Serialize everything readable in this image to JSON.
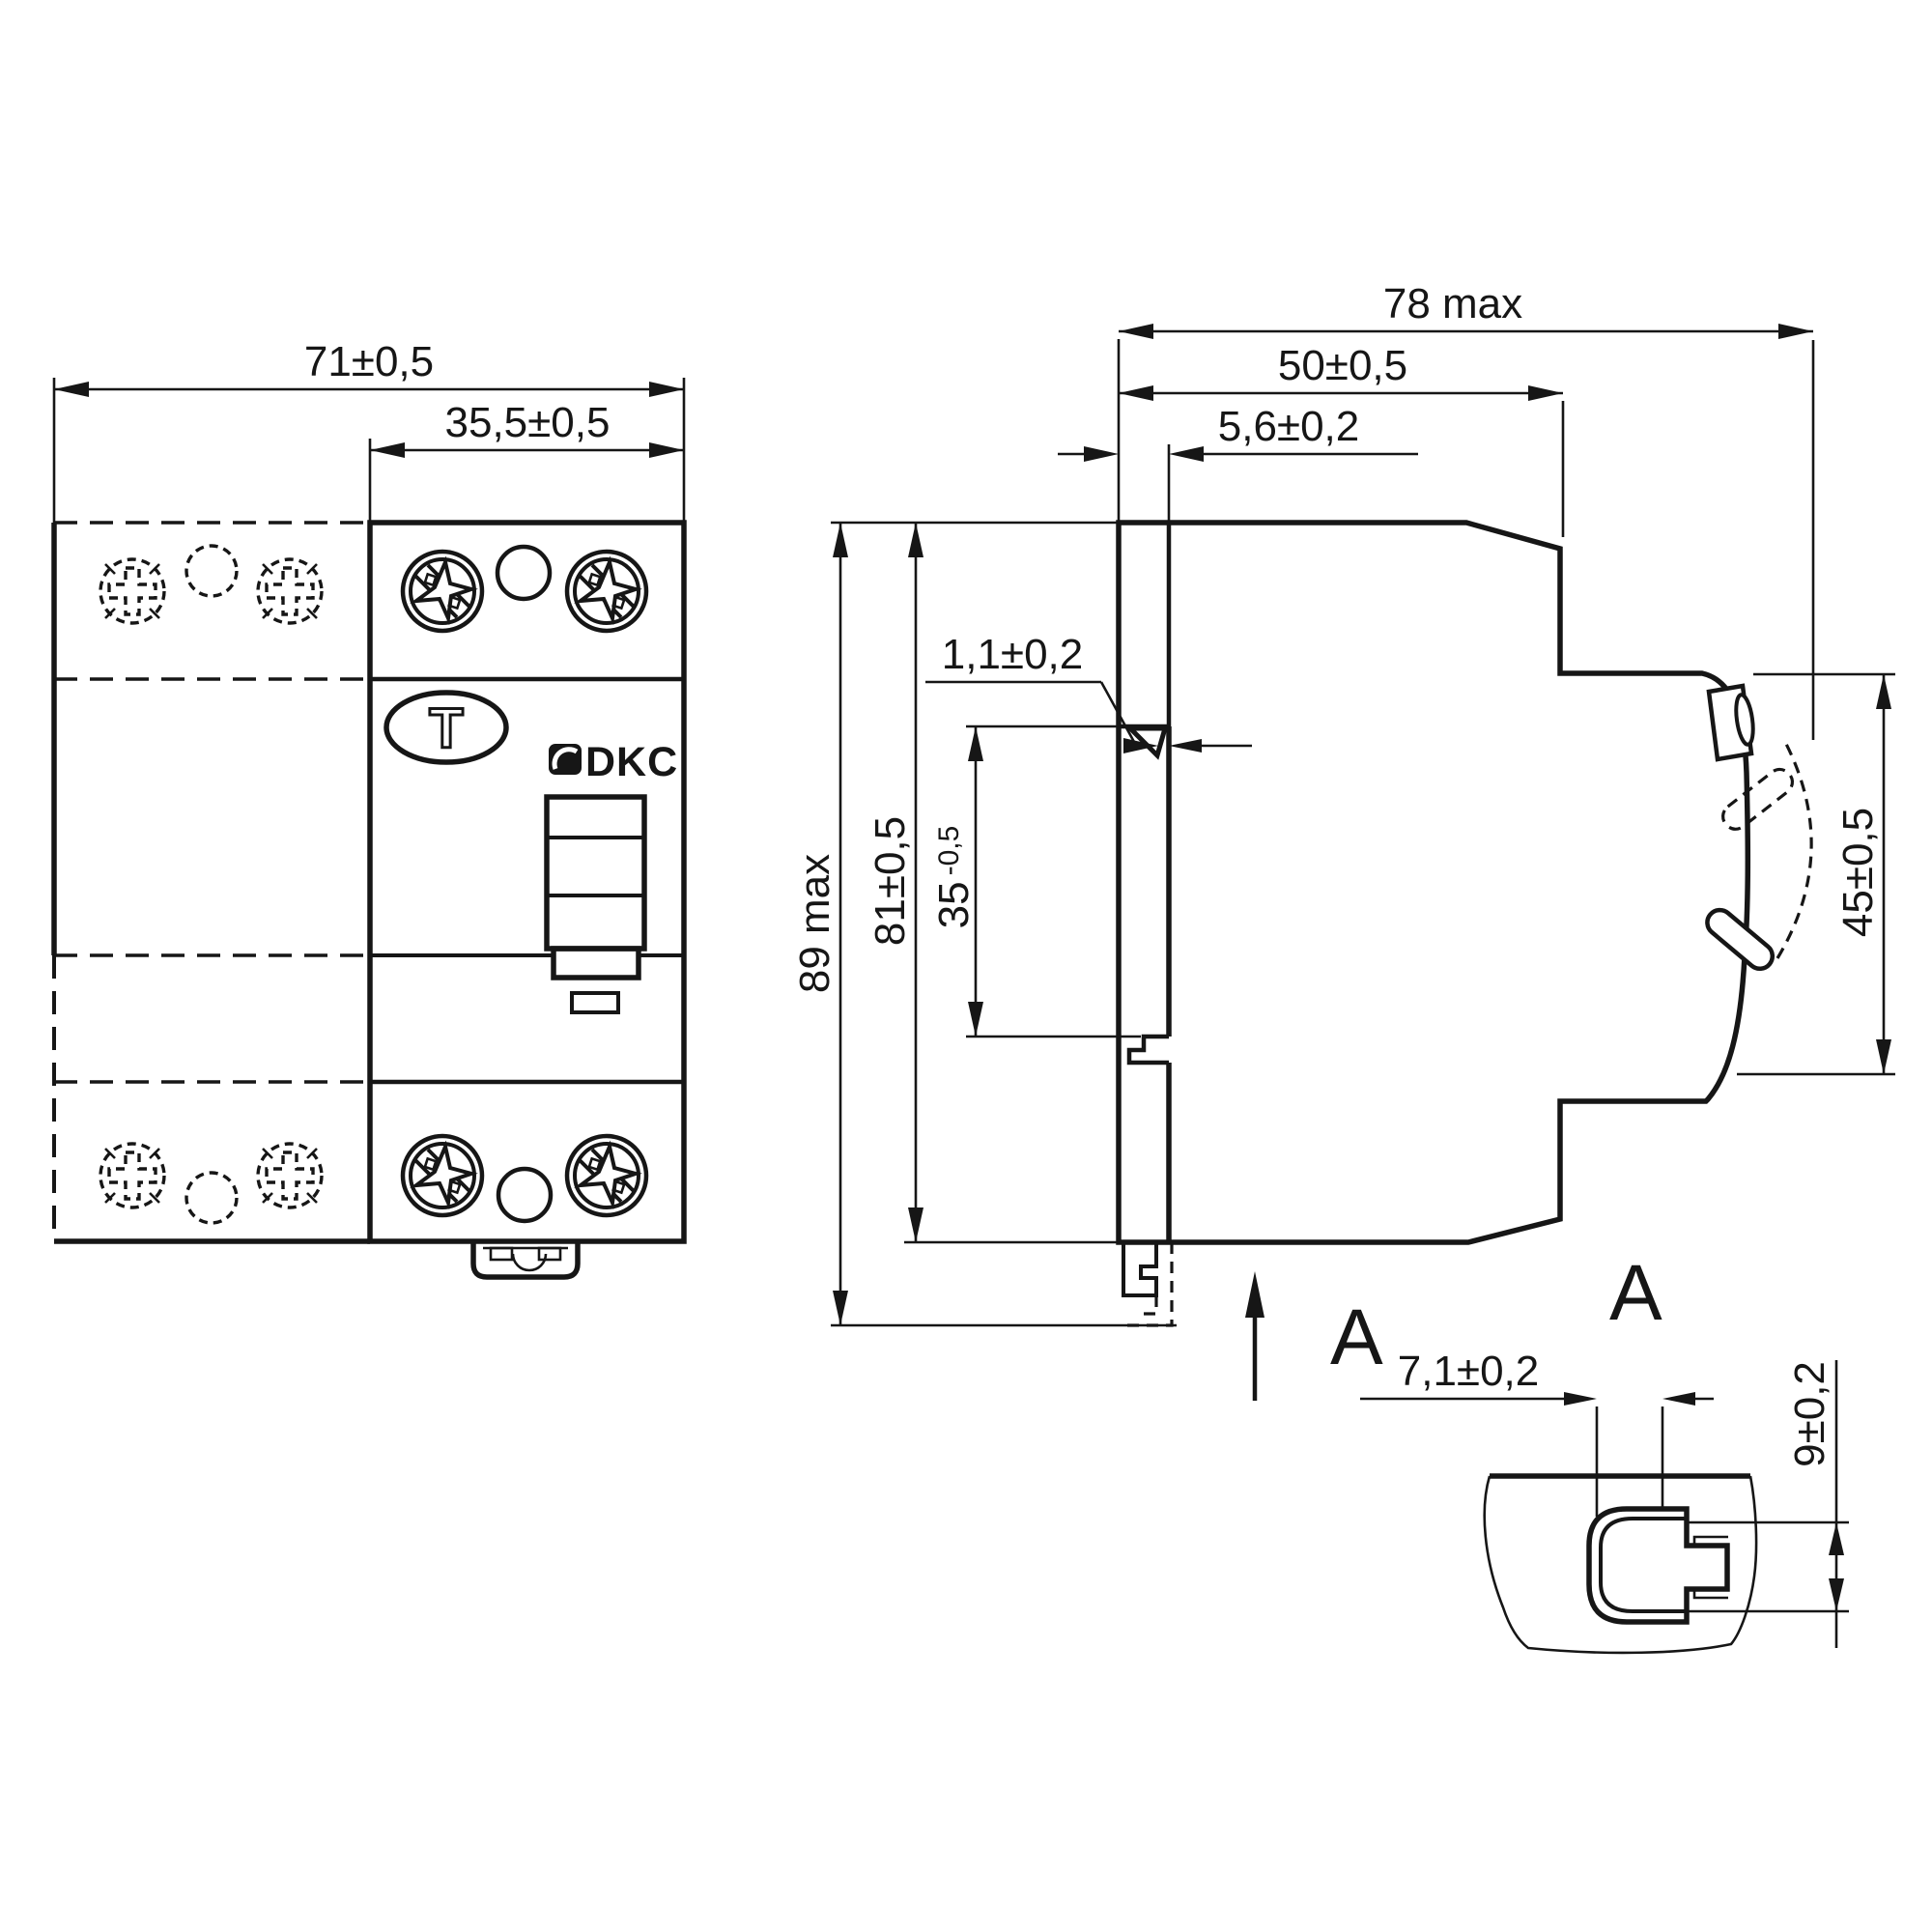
{
  "style": {
    "ink": "#161616",
    "background": "#ffffff"
  },
  "front_view": {
    "dim_width": "71±0,5",
    "dim_module_width": "35,5±0,5",
    "test_button_label": "T",
    "brand": "DKC"
  },
  "side_view": {
    "dim_depth_max": "78 max",
    "dim_depth": "50±0,5",
    "dim_din_offset": "5,6±0,2",
    "dim_notch": "1,1±0,2",
    "dim_height_max": "89 max",
    "dim_height": "81±0,5",
    "dim_rail_width": "35",
    "dim_rail_tolerance": "-0,5",
    "dim_front_height": "45±0,5",
    "view_label": "A"
  },
  "detail_view": {
    "title": "A",
    "dim_width": "7,1±0,2",
    "dim_height": "9±0,2"
  }
}
